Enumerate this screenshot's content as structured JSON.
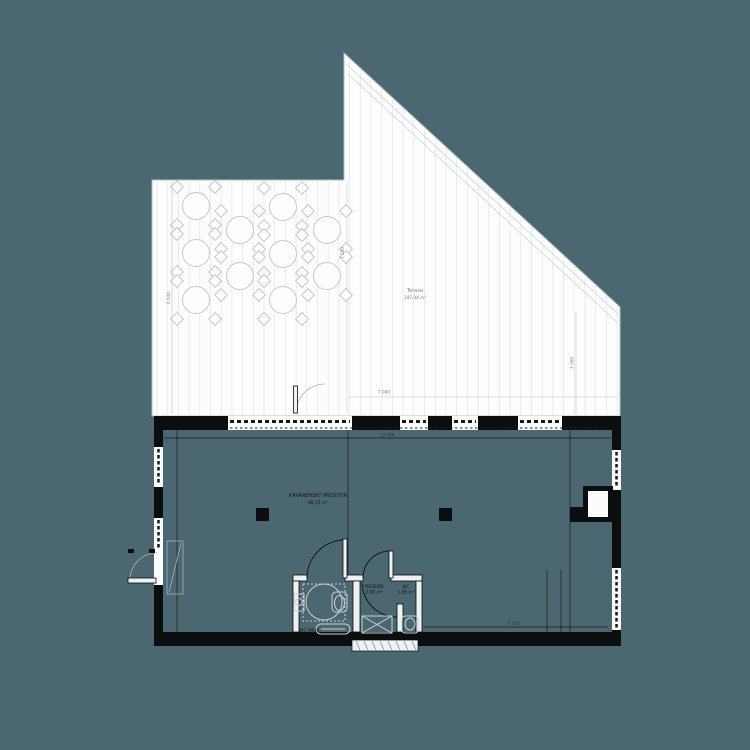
{
  "colors": {
    "background": "#4b6771",
    "paper": "#fdfdfd",
    "wall_black": "#0b0d0e",
    "fixture_gray": "#c9d0d4",
    "dim_text_gray": "#7d878c"
  },
  "terrace": {
    "label": {
      "name": "Terasa",
      "area": "147,94 m²"
    },
    "dims": {
      "left": "6 540",
      "center": "7 240",
      "right": "3 360",
      "bottom": "7 040"
    },
    "tables": [
      {
        "x": 196,
        "y": 206
      },
      {
        "x": 196,
        "y": 253
      },
      {
        "x": 196,
        "y": 300
      },
      {
        "x": 240,
        "y": 230
      },
      {
        "x": 240,
        "y": 276
      },
      {
        "x": 283,
        "y": 207
      },
      {
        "x": 283,
        "y": 254
      },
      {
        "x": 283,
        "y": 300
      },
      {
        "x": 327,
        "y": 230
      },
      {
        "x": 327,
        "y": 276
      }
    ]
  },
  "building": {
    "dims": {
      "top": "13 740",
      "interior": "5 170"
    },
    "room": {
      "label": "KAVÁRENSKÝ PROSTOR",
      "area": "98,75 m²"
    },
    "rooms": {
      "wc_accessible": {
        "label": "WC IMOB.",
        "area": "4,15 m²"
      },
      "vestibule": {
        "label": "PŘEDSÍŇ",
        "area": "2,90 m²"
      },
      "wc": {
        "label": "WC",
        "area": "1,85 m²"
      }
    }
  }
}
